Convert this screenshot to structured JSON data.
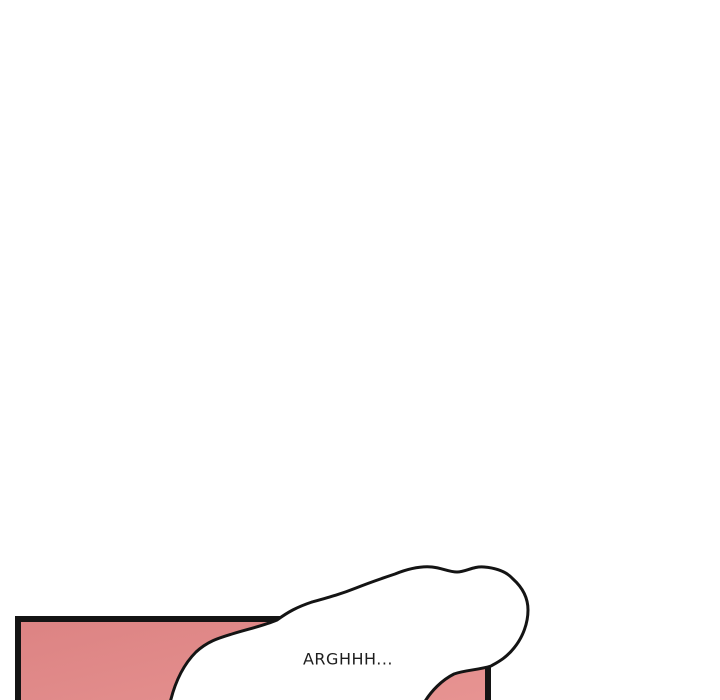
{
  "page": {
    "background_color": "#ffffff",
    "description": "webtoon strip segment, mostly blank with partial panel at bottom"
  },
  "panel": {
    "fill_color_start": "#dc8383",
    "fill_color_end": "#e99694",
    "border_color": "#141414"
  },
  "speech_bubble": {
    "text": "ARGHHH...",
    "fill_color": "#ffffff",
    "outline_color": "#141414",
    "text_color": "#1d1d1d"
  }
}
